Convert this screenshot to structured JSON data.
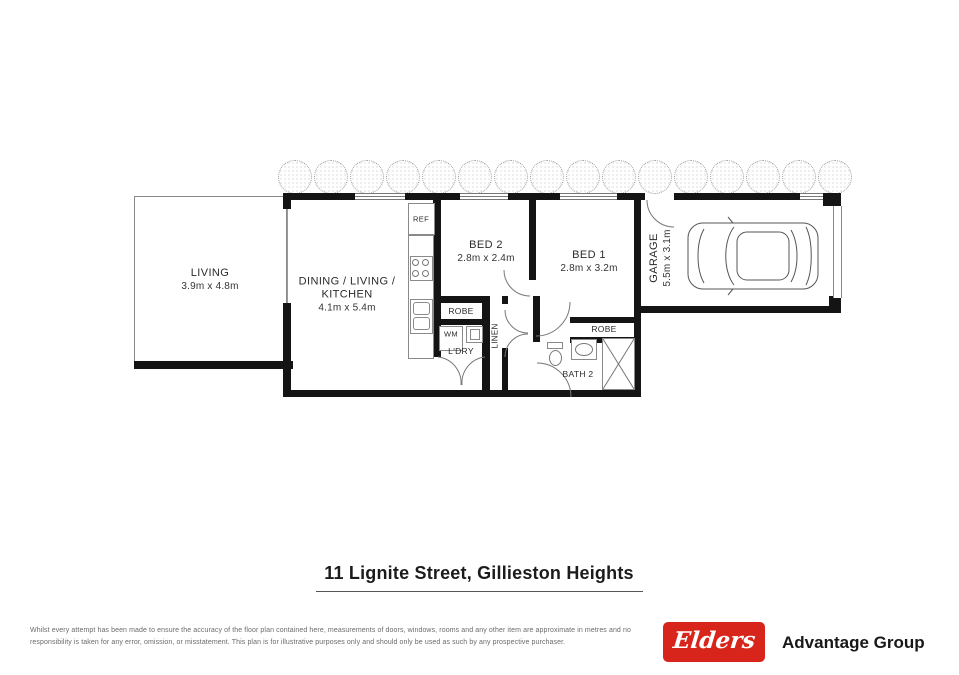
{
  "floorplan": {
    "tree_count": 16,
    "rooms": {
      "living": {
        "name": "LIVING",
        "dims": "3.9m x 4.8m"
      },
      "dining": {
        "name": "DINING / LIVING / KITCHEN",
        "dims": "4.1m x 5.4m"
      },
      "bed2": {
        "name": "BED 2",
        "dims": "2.8m x 2.4m"
      },
      "bed1": {
        "name": "BED 1",
        "dims": "2.8m x 3.2m"
      },
      "garage": {
        "name": "GARAGE",
        "dims": "5.5m x 3.1m"
      },
      "bath2": {
        "name": "BATH 2"
      }
    },
    "fixtures": {
      "ref": "REF",
      "robe_laundry": "ROBE",
      "wm": "WM",
      "ldry": "L'DRY",
      "linen": "LINEN",
      "robe_bed1": "ROBE"
    }
  },
  "title": "11 Lignite Street, Gillieston Heights",
  "disclaimer": {
    "line1": "Whilst every attempt has been made to ensure the accuracy of the floor plan contained here, measurements of doors, windows, rooms and any other item are approximate in metres and no",
    "line2": "responsibility is taken for any error, omission, or misstatement. This plan is for illustrative purposes only and should only be used as such by any prospective purchaser."
  },
  "branding": {
    "logo_text": "Elders",
    "group_name": "Advantage Group",
    "logo_color": "#d8251c"
  }
}
